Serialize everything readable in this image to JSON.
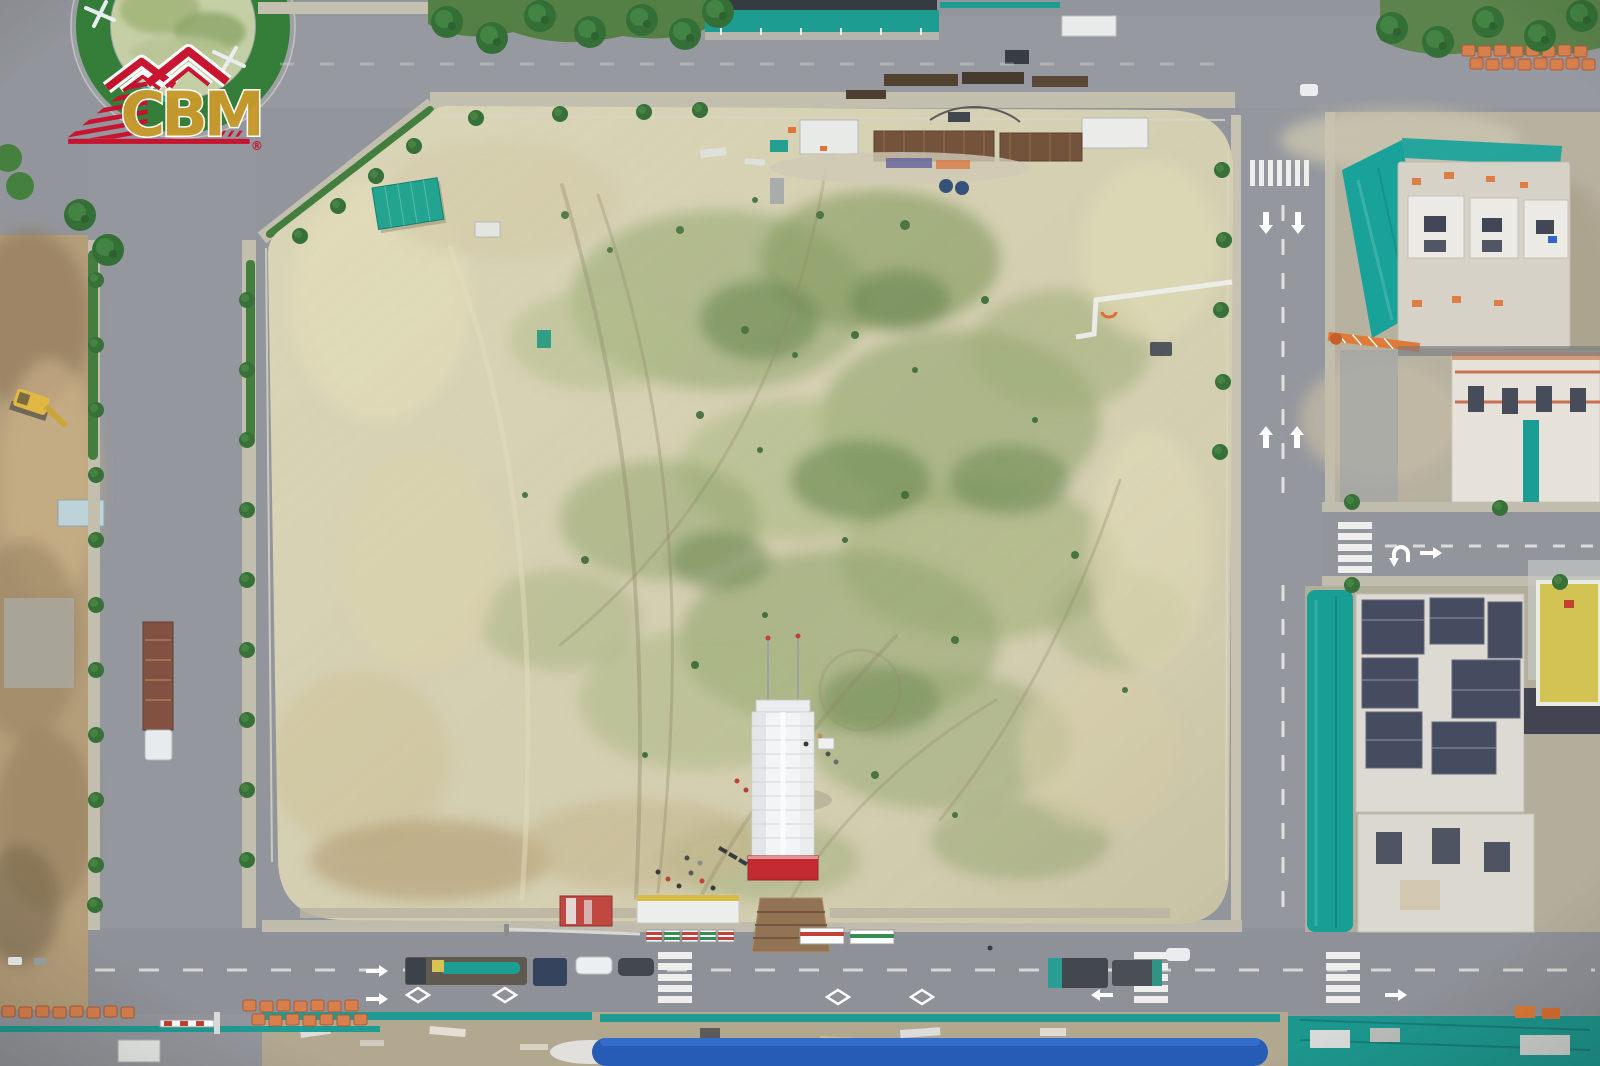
{
  "watermark": {
    "logo_text": "CBM",
    "registered_mark": "®",
    "logo_gold": "#c7992e",
    "logo_red": "#c8102e",
    "logo_outline": "#ffffff"
  },
  "scene": {
    "type": "aerial-drone-photograph",
    "subject": "Top-down aerial view of a cleared construction lot bounded by roads, with an event tent, material laydown yards and neighbouring mid-rise buildings under construction wrapped in teal safety netting",
    "palette": {
      "asphalt": "#8f9297",
      "sidewalk": "#c2beac",
      "lot_sand": "#d4cfae",
      "grass_green": "#8fa468",
      "deep_green": "#3c6a33",
      "teal_netting": "#10a096",
      "tent_white": "#f4f6f7",
      "stage_red": "#c32127",
      "brick_orange": "#d97c45",
      "roof_blue": "#1d55b4",
      "roof_yellow": "#d3c24b",
      "formwork_navy": "#3f4559",
      "rust_brown": "#6e4c33",
      "truck_teal": "#1f9a8f",
      "excavator_yellow": "#e2b73c",
      "hedge_green": "#2c7a31"
    },
    "landmarks": [
      "traffic-roundabout-with-green-hedge-ring",
      "cleared-sandy-lot-with-grass-patches-and-tire-tracks",
      "white-event-tent-with-red-stage-carpet",
      "green-site-shed",
      "steel-pile-laydown-area-with-containers",
      "buildings-under-construction-with-teal-safety-netting",
      "navy-formwork-rooftops",
      "yellow-roofed-building",
      "long-blue-roofed-building",
      "orange-brick-pallet-rows",
      "tower-crane-boom",
      "yellow-excavator",
      "rusty-flatbed-truck",
      "teal-mobile-crane-truck",
      "zebra-crosswalks-and-lane-arrows",
      "roadside-trees-and-hedges"
    ]
  }
}
